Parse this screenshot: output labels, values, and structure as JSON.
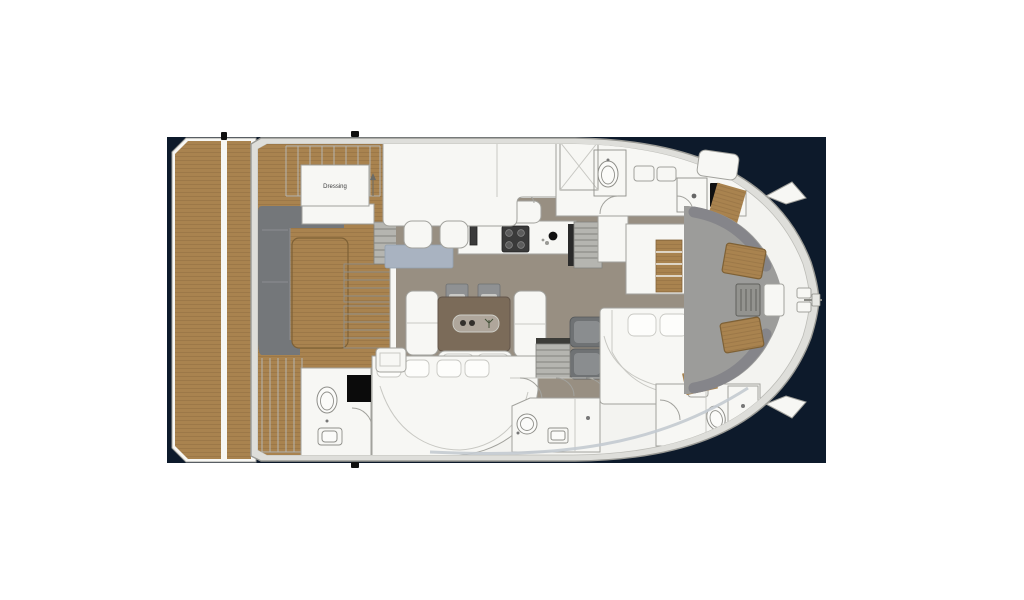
{
  "page": {
    "background": "#ffffff"
  },
  "colors": {
    "water": "#0d1a2b",
    "hullEdge": "#dededa",
    "hullInner": "#f3f3f0",
    "hullStroke": "#9a9a95",
    "rimLine": "#bcbcb7",
    "module": "#f7f7f4",
    "moduleStroke": "#a2a29d",
    "lineLight": "#c8c8c3",
    "floor": "#988f82",
    "teak": "#a9834f",
    "teakLine": "#84633a",
    "teakEdge": "#7e6136",
    "sofa": "#74777a",
    "sofaSeam": "#8b8e91",
    "foredeck": "#9c9c9a",
    "foredeckEdge": "#85858a",
    "tableBrown": "#7b6b59",
    "chairGray": "#8f9193",
    "armchair": "#6f7274",
    "stair": "#b5b5b0",
    "stairLine": "#83837e",
    "appliance": "#3a3a3a",
    "dark": "#101010",
    "rug": "#a9b3c1",
    "cushion": "#fdfdfb",
    "railLine": "#b5b5b0"
  },
  "floorplan": {
    "type": "catamaran-yacht-deck-plan",
    "orientation": "bow-right",
    "labels": {
      "dressing": "Dressing"
    },
    "features": [
      "swim-platform",
      "aft-deck-railing",
      "cockpit-sofa",
      "cockpit-teak-table",
      "salon-dining-table",
      "dining-chairs",
      "galley-counter",
      "stove-icon",
      "sink-icon",
      "port-hull-stairs",
      "starboard-hull-stairs",
      "dressing-room",
      "master-cabin-roof",
      "port-head-toilet-icon",
      "shower-icon",
      "tv-panel",
      "storage-cabinets",
      "aft-guest-bed",
      "forward-guest-bed",
      "aft-bathroom-toilet-icon",
      "washbasin-icon",
      "mid-bathroom-toilet-icon",
      "forward-head-toilet-icon",
      "armchairs",
      "foredeck-lounge",
      "foredeck-teak-tables",
      "deck-grate",
      "bow-hatch",
      "anchor-roller",
      "cleats",
      "door-swing-arcs",
      "rug"
    ]
  }
}
